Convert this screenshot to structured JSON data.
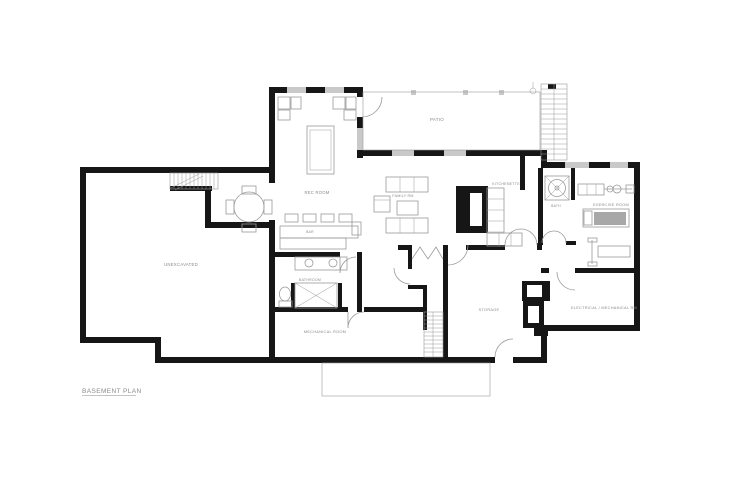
{
  "drawing": {
    "title": "BASEMENT PLAN"
  },
  "rooms": {
    "patio": "PATIO",
    "rec_room": "REC ROOM",
    "bar": "BAR",
    "family_room": "FAMILY RM",
    "kitchenette": "KITCHENETTE",
    "bath": "BATH",
    "exercise_room": "EXERCISE ROOM",
    "unexcavated": "UNEXCAVATED",
    "bathroom": "BATHROOM",
    "mechanical_room": "MECHANICAL ROOM",
    "storage": "STORAGE",
    "electrical_room": "ELECTRICAL / MECHANICAL RM"
  },
  "colors": {
    "background": "#ffffff",
    "wall": "#161616",
    "window": "#c9c9c9",
    "furniture_line": "#9a9a9a",
    "label": "#8a8a8a",
    "treadmill_fill": "#a8a8a8",
    "inset": "#ffffff"
  },
  "fixtures": [
    "pool-table",
    "lounge-chairs",
    "wet-bar",
    "bar-stools",
    "dining-table",
    "dining-chairs",
    "sofa",
    "armchair",
    "coffee-table",
    "fireplace",
    "kitchenette-counters",
    "shower-stall",
    "double-vanity",
    "toilet",
    "tub-shower",
    "barbell-rack",
    "treadmill",
    "weight-bench",
    "interior-stairs",
    "exterior-stairs",
    "basement-stairs",
    "bifold-closet-doors",
    "double-doors",
    "door-swings",
    "chimney-foundation",
    "patio-deck",
    "concrete-slab"
  ]
}
